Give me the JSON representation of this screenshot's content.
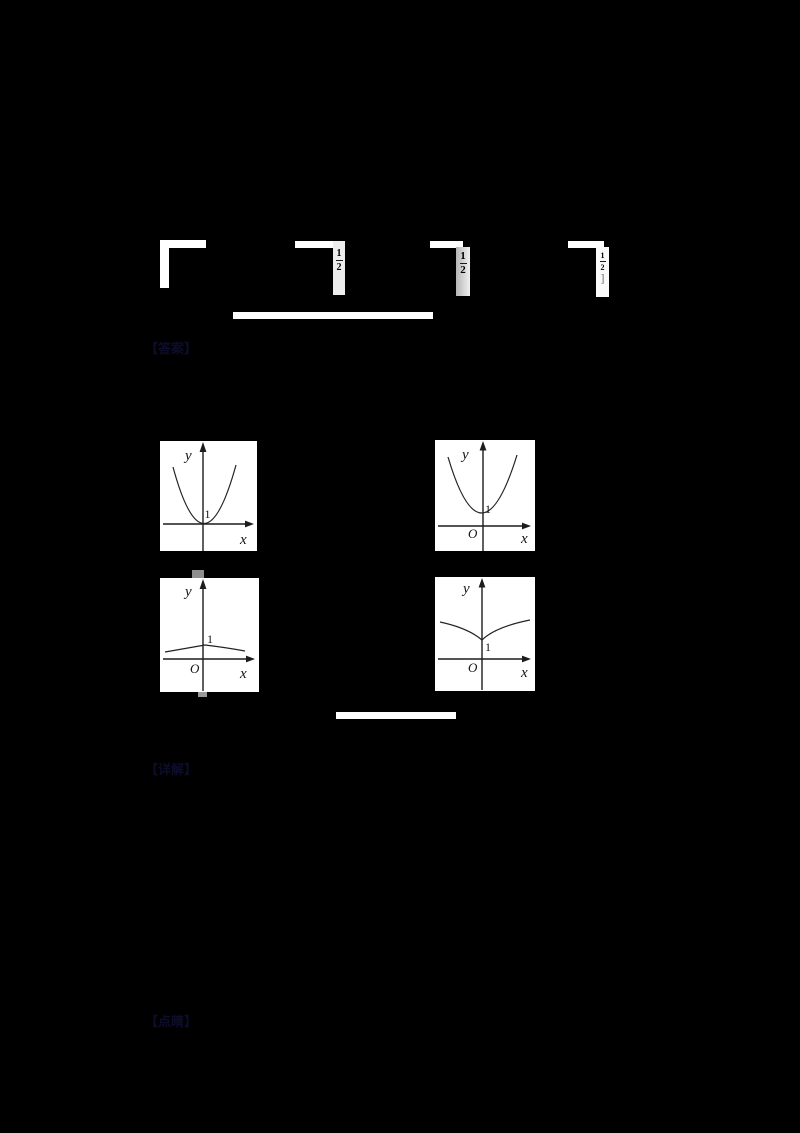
{
  "appearance": {
    "background": "#000000",
    "panel_background": "#ffffff",
    "stroke_color": "#1c1c1c",
    "faint_text_color": "#0d0d2b",
    "divider_color": "#ffffff"
  },
  "faint_labels": [
    {
      "text": "【答案】"
    },
    {
      "text": "【详解】"
    },
    {
      "text": "【点睛】"
    }
  ],
  "formula_fragments": {
    "frag2": {
      "numerator": "1",
      "denominator": "2"
    },
    "frag3": {
      "numerator": "1",
      "denominator": "2"
    },
    "frag4": {
      "numerator": "1",
      "denominator": "2",
      "bracket": "]"
    }
  },
  "graph_panels": [
    {
      "name": "upward-parabola-vertex-at-origin",
      "labels": {
        "y": "y",
        "x": "x",
        "one": "1"
      }
    },
    {
      "name": "upward-parabola-vertex-at-0-1",
      "labels": {
        "y": "y",
        "x": "x",
        "origin": "O",
        "one": "1"
      }
    },
    {
      "name": "flat-peak-at-0-1",
      "labels": {
        "y": "y",
        "x": "x",
        "origin": "O",
        "one": "1"
      }
    },
    {
      "name": "cusp-minimum-at-0-1",
      "labels": {
        "y": "y",
        "x": "x",
        "origin": "O",
        "one": "1"
      }
    }
  ]
}
